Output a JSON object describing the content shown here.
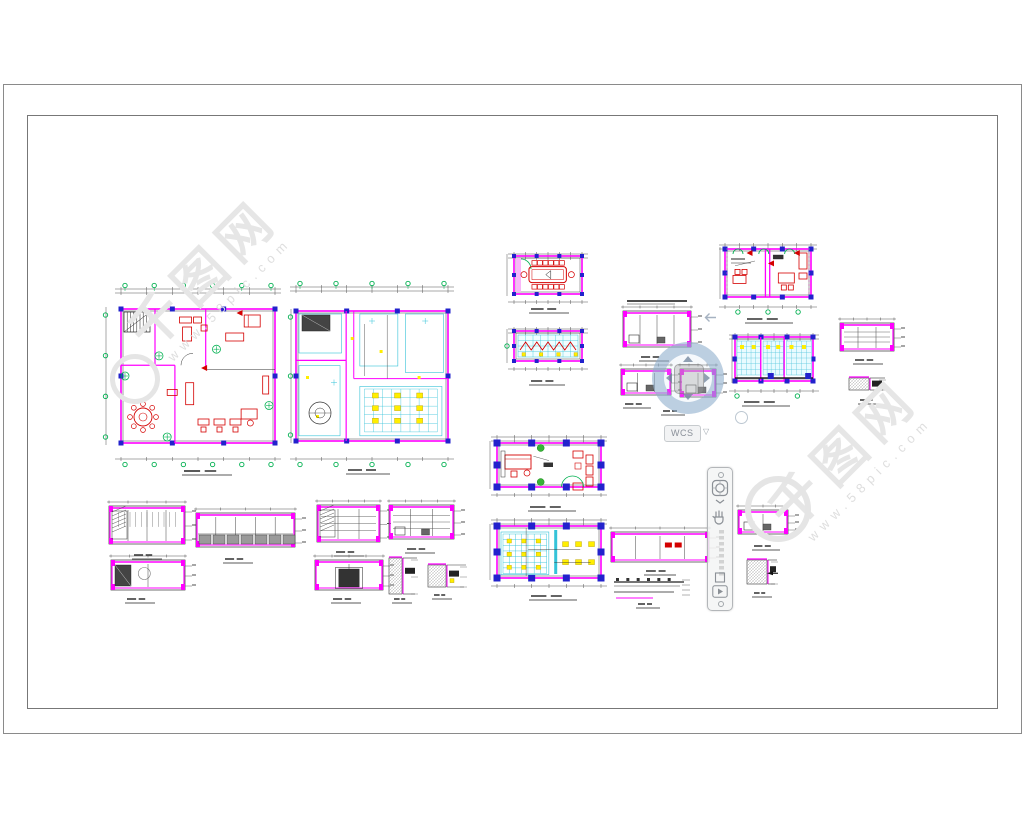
{
  "ui": {
    "wcs_label": "WCS",
    "wcs_dropdown_glyph": "▽",
    "navbar": {
      "buttons": [
        "navigation-wheel",
        "expand-chevron",
        "pan",
        "zoom-window",
        "showmotion"
      ]
    }
  },
  "watermark": {
    "brand": "千图网",
    "site": "www.58pic.com"
  },
  "colors": {
    "wall": "#ff00ff",
    "column": "#2222cc",
    "furniture": "#d40000",
    "axis_green": "#00b050",
    "ceiling_cyan": "#35c3d8",
    "light_yellow": "#ffee00",
    "line": "#333333",
    "sheet_border": "#8a8a8a",
    "watermark_gray": "#e6e6e6"
  },
  "canvas": {
    "blocks": [
      {
        "id": "plan-a",
        "kind": "planA",
        "x": 103,
        "y": 283,
        "w": 184,
        "h": 184,
        "cap": [
          207,
          473
        ],
        "capw": 46
      },
      {
        "id": "plan-b",
        "kind": "planB",
        "x": 288,
        "y": 281,
        "w": 170,
        "h": 186,
        "cap": [
          368,
          472
        ],
        "capw": 40
      },
      {
        "id": "room-conference",
        "kind": "conf",
        "x": 504,
        "y": 248,
        "w": 84,
        "h": 62,
        "cap": [
          549,
          311
        ],
        "capw": 36
      },
      {
        "id": "room-ceiling",
        "kind": "ceilSmall",
        "x": 504,
        "y": 323,
        "w": 84,
        "h": 54,
        "cap": [
          547,
          383
        ],
        "capw": 32
      },
      {
        "id": "plan-offices",
        "kind": "offices",
        "x": 717,
        "y": 239,
        "w": 102,
        "h": 76,
        "cap": [
          769,
          321
        ],
        "capw": 44
      },
      {
        "id": "elev-a",
        "kind": "elev",
        "x": 619,
        "y": 305,
        "w": 76,
        "h": 50,
        "o": {
          "cols": 4,
          "bits": true
        },
        "cap": [
          654,
          359
        ],
        "capw": 26
      },
      {
        "id": "elev-b",
        "kind": "elev",
        "x": 617,
        "y": 363,
        "w": 58,
        "h": 40,
        "o": {
          "cols": 3,
          "bits": true
        },
        "cap": [
          637,
          406
        ],
        "capw": 24
      },
      {
        "id": "elev-c",
        "kind": "elev",
        "x": 676,
        "y": 363,
        "w": 44,
        "h": 42,
        "o": {
          "cols": 2,
          "bits": true
        },
        "cap": [
          673,
          413
        ],
        "capw": 20
      },
      {
        "id": "plan-bays",
        "kind": "bays",
        "x": 729,
        "y": 329,
        "w": 90,
        "h": 70,
        "cap": [
          766,
          404
        ],
        "capw": 44
      },
      {
        "id": "elev-tr",
        "kind": "elev",
        "x": 836,
        "y": 317,
        "w": 62,
        "h": 42,
        "o": {
          "cols": 3,
          "shelf": true
        },
        "cap": [
          868,
          362
        ],
        "capw": 26
      },
      {
        "id": "detail-tr",
        "kind": "detail",
        "x": 847,
        "y": 374,
        "w": 40,
        "h": 22,
        "o": {
          "hw": 20
        },
        "cap": [
          869,
          402
        ],
        "capw": 18
      },
      {
        "id": "plan-c",
        "kind": "planC",
        "x": 487,
        "y": 431,
        "w": 124,
        "h": 72,
        "cap": [
          552,
          509
        ],
        "capw": 44
      },
      {
        "id": "plan-d",
        "kind": "planD",
        "x": 487,
        "y": 514,
        "w": 124,
        "h": 80,
        "cap": [
          553,
          598
        ],
        "capw": 44
      },
      {
        "id": "elev-bl1",
        "kind": "elev",
        "x": 105,
        "y": 500,
        "w": 84,
        "h": 52,
        "o": {
          "cols": 4,
          "vdense": true,
          "hatchL": true
        },
        "cap": [
          147,
          557
        ],
        "capw": 26
      },
      {
        "id": "elev-bl2",
        "kind": "elev",
        "x": 192,
        "y": 507,
        "w": 107,
        "h": 48,
        "o": {
          "cols": 5,
          "cab": true
        },
        "cap": [
          238,
          561
        ],
        "capw": 26
      },
      {
        "id": "elev-bl3",
        "kind": "elev",
        "x": 107,
        "y": 554,
        "w": 82,
        "h": 44,
        "o": {
          "cols": 2,
          "door": true
        },
        "cap": [
          140,
          601
        ],
        "capw": 26
      },
      {
        "id": "elev-bm1",
        "kind": "elev",
        "x": 313,
        "y": 499,
        "w": 71,
        "h": 51,
        "o": {
          "cols": 3,
          "shelf": true,
          "hatchL": true
        },
        "cap": [
          349,
          554
        ],
        "capw": 26
      },
      {
        "id": "elev-bm2",
        "kind": "elev",
        "x": 385,
        "y": 499,
        "w": 73,
        "h": 48,
        "o": {
          "cols": 3,
          "shelf": true,
          "bits": true
        },
        "cap": [
          420,
          551
        ],
        "capw": 26
      },
      {
        "id": "elev-bm3",
        "kind": "elev",
        "x": 311,
        "y": 554,
        "w": 76,
        "h": 44,
        "o": {
          "cols": 2,
          "dark": true
        },
        "cap": [
          346,
          601
        ],
        "capw": 26
      },
      {
        "id": "detail-bm1",
        "kind": "detail",
        "x": 387,
        "y": 554,
        "w": 32,
        "h": 46,
        "o": {
          "hw": 13
        },
        "cap": [
          402,
          601
        ],
        "capw": 16
      },
      {
        "id": "detail-bm2",
        "kind": "detail",
        "x": 426,
        "y": 561,
        "w": 42,
        "h": 32,
        "o": {
          "hw": 18,
          "yellow": true
        },
        "cap": [
          442,
          597
        ],
        "capw": 16
      },
      {
        "id": "elev-bc",
        "kind": "elev",
        "x": 607,
        "y": 526,
        "w": 106,
        "h": 44,
        "o": {
          "cols": 4,
          "red": true
        },
        "cap": [
          660,
          573
        ],
        "capw": 28
      },
      {
        "id": "detail-bc",
        "kind": "detail",
        "x": 612,
        "y": 576,
        "w": 82,
        "h": 28,
        "o": {
          "flat": true
        },
        "cap": [
          648,
          606
        ],
        "capw": 20
      },
      {
        "id": "elev-r",
        "kind": "elev",
        "x": 734,
        "y": 504,
        "w": 58,
        "h": 38,
        "o": {
          "cols": 2,
          "bits": true
        },
        "cap": [
          766,
          548
        ],
        "capw": 24
      },
      {
        "id": "detail-r",
        "kind": "detail",
        "x": 745,
        "y": 556,
        "w": 34,
        "h": 34,
        "o": {
          "hw": 20,
          "flag": true
        },
        "cap": [
          762,
          595
        ],
        "capw": 16
      }
    ],
    "extras": [
      {
        "type": "capline",
        "x": 627,
        "y": 299,
        "w": 60
      }
    ]
  }
}
